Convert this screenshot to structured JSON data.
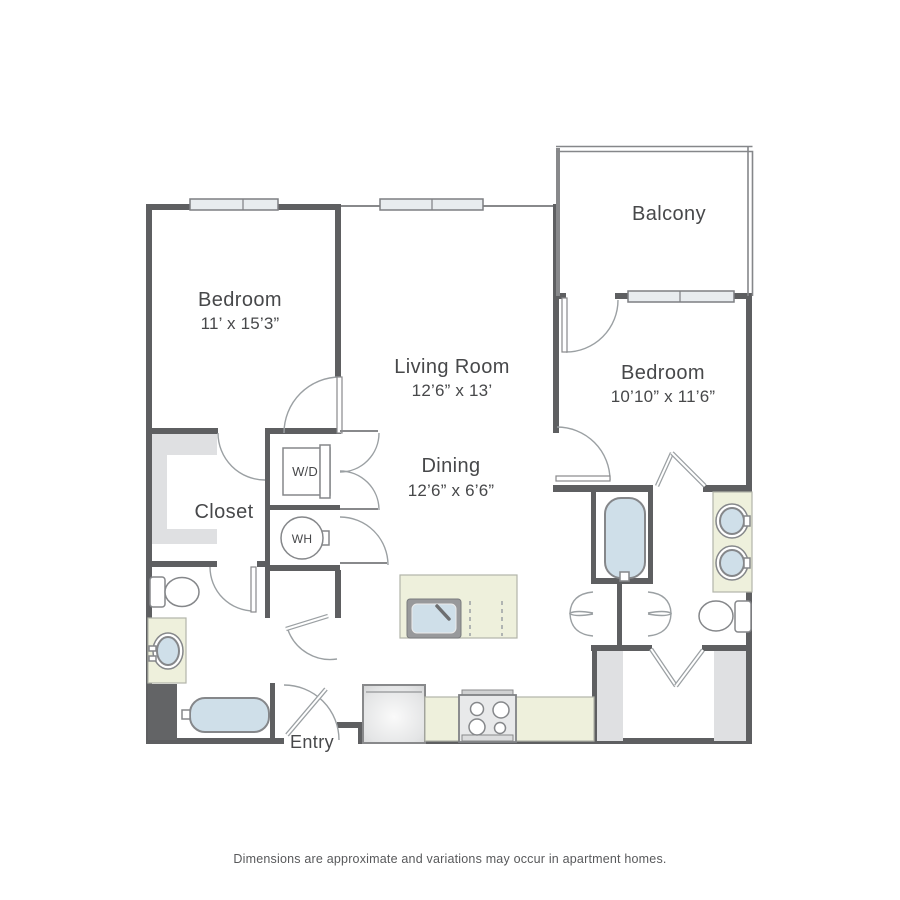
{
  "palette": {
    "wall": "#5e5f61",
    "line": "#88898b",
    "arc": "#9ba0a3",
    "fixline": "#85878a",
    "window_fill": "#e8ecef",
    "counter": "#eef0dc",
    "water": "#cfdfe9",
    "shelf": "#dfe0e2",
    "dark_block": "#636466",
    "text": "#47484a"
  },
  "rooms": {
    "bedroom1": {
      "name": "Bedroom",
      "dims": "11’ x 15’3”"
    },
    "living": {
      "name": "Living Room",
      "dims": "12’6” x 13’"
    },
    "balcony": {
      "name": "Balcony"
    },
    "bedroom2": {
      "name": "Bedroom",
      "dims": "10’10” x 11’6”"
    },
    "dining": {
      "name": "Dining",
      "dims": "12’6” x 6’6”"
    },
    "closet": {
      "name": "Closet"
    },
    "entry": {
      "name": "Entry"
    }
  },
  "fixtures": {
    "washer_dryer": "W/D",
    "water_heater": "WH"
  },
  "footer": {
    "disclaimer": "Dimensions are approximate and variations may occur in apartment homes."
  }
}
